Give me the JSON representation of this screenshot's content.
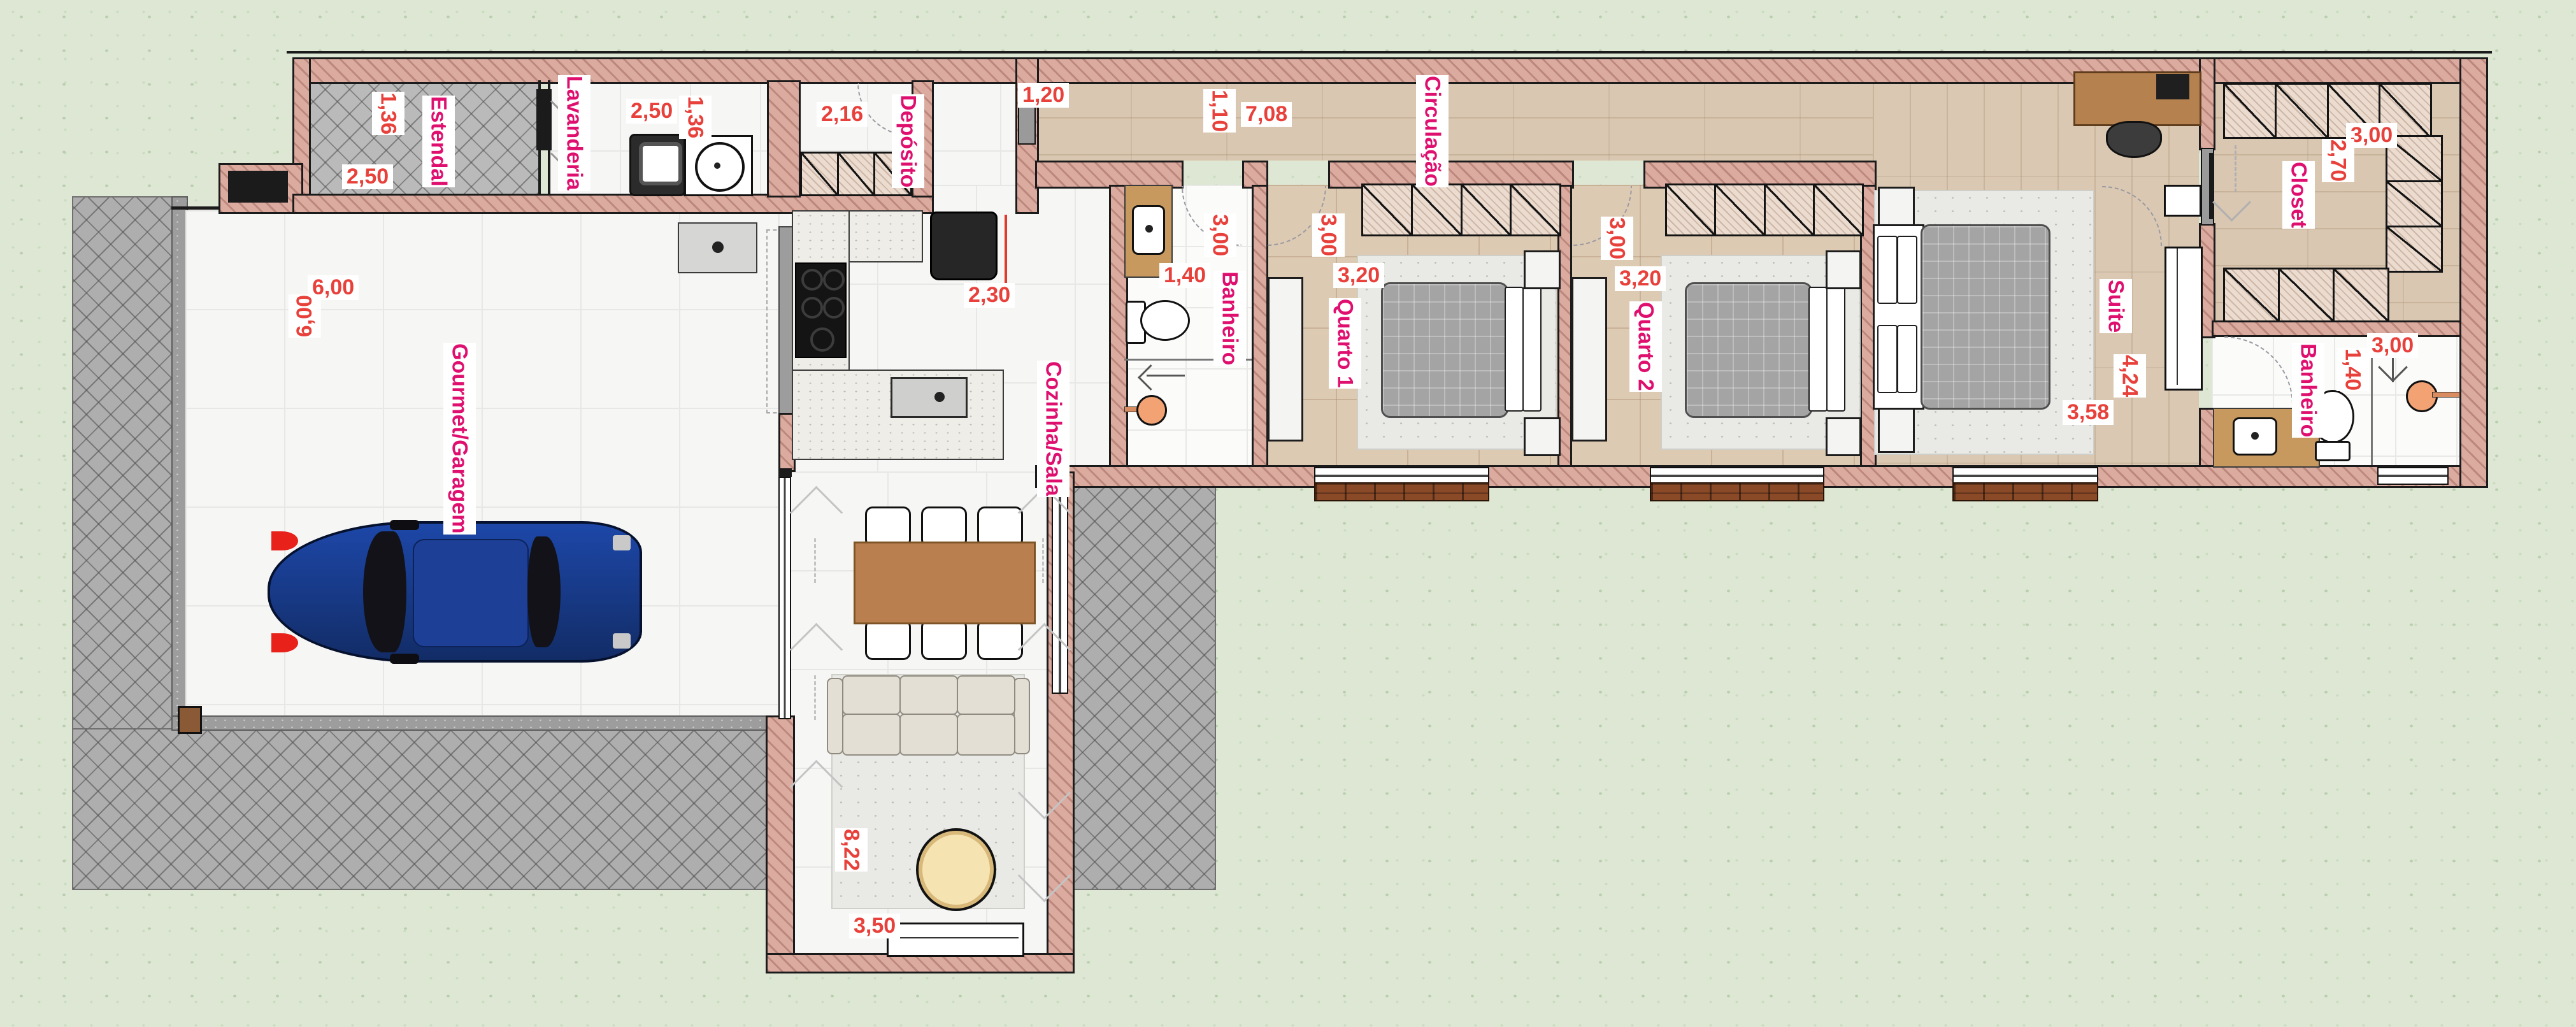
{
  "plan_title": "Planta baixa residencial",
  "colors": {
    "room_label": "#df0f6f",
    "dim_label": "#e8403a",
    "wall_fill": "#dcaba0",
    "grass": "#dde7d3",
    "paving": "#aeaeae",
    "wood_floor": "#d9c7b1",
    "car": "#1d47a8"
  },
  "rooms": {
    "estendal": {
      "name": "Estendal",
      "dim_a": "1,36",
      "dim_b": "2,50"
    },
    "lavanderia": {
      "name": "Lavanderia",
      "dim_a": "2,50",
      "dim_b": "1,36"
    },
    "deposito": {
      "name": "Depósito",
      "dim_a": "2,16"
    },
    "hall": {
      "dim_a": "1,20"
    },
    "circulacao": {
      "name": "Circulação",
      "dim_a": "1,10",
      "dim_b": "7,08"
    },
    "banheiro1": {
      "name": "Banheiro",
      "dim_a": "3,00",
      "dim_b": "1,40"
    },
    "quarto1": {
      "name": "Quarto 1",
      "dim_a": "3,00",
      "dim_b": "3,20"
    },
    "quarto2": {
      "name": "Quarto 2",
      "dim_a": "3,00",
      "dim_b": "3,20"
    },
    "suite": {
      "name": "Suite",
      "dim_a": "4,24",
      "dim_b": "3,58"
    },
    "closet": {
      "name": "Closet",
      "dim_a": "3,00",
      "dim_b": "2,70"
    },
    "banheiro2": {
      "name": "Banheiro",
      "dim_a": "1,40",
      "dim_b": "3,00"
    },
    "gourmet": {
      "name": "Gourmet/Garagem",
      "dim_a": "6,00",
      "dim_b": "6,00"
    },
    "cozinha": {
      "name": "Cozinha/Sala",
      "dim_a": "2,30",
      "dim_b": "8,22",
      "dim_c": "3,50"
    }
  }
}
